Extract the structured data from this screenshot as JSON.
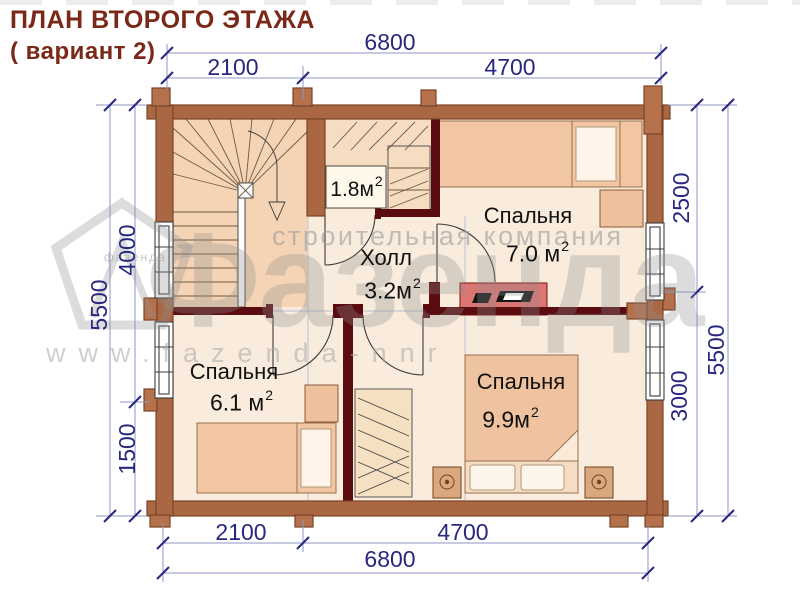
{
  "title": {
    "line1": "ПЛАН ВТОРОГО ЭТАЖА",
    "line2": "( вариант 2)"
  },
  "dims": {
    "top_total": "6800",
    "top_left": "2100",
    "top_right": "4700",
    "bottom_left": "2100",
    "bottom_right": "4700",
    "bottom_total": "6800",
    "left_total": "5500",
    "left_upper": "4000",
    "left_lower": "1500",
    "right_upper": "2500",
    "right_lower": "3000",
    "right_total": "5500"
  },
  "rooms": {
    "closet": {
      "area": "1.8м",
      "sup": "2"
    },
    "hall": {
      "name": "Холл",
      "area": "3.2м",
      "sup": "2"
    },
    "bedroom_top": {
      "name": "Спальня",
      "area": "7.0 м",
      "sup": "2"
    },
    "bedroom_left": {
      "name": "Спальня",
      "area": "6.1 м",
      "sup": "2"
    },
    "bedroom_right": {
      "name": "Спальня",
      "area": "9.9м",
      "sup": "2"
    }
  },
  "watermark": {
    "tagline": "строительная компания",
    "brand": "Фазенда",
    "logo_text": "фазенда",
    "url": "www.fazenda-nnr"
  },
  "colors": {
    "title_text": "#7a2817",
    "dimension_text": "#28287e",
    "dimension_line": "#8d97c4",
    "log_wall": "#a96744",
    "partition_wall": "#5a0c10",
    "room_fill": "#f9ecdc",
    "stairs_fill": "#f4d4b4",
    "furniture_fill": "#f2c6a3",
    "dresser_red": "#dc7672"
  }
}
